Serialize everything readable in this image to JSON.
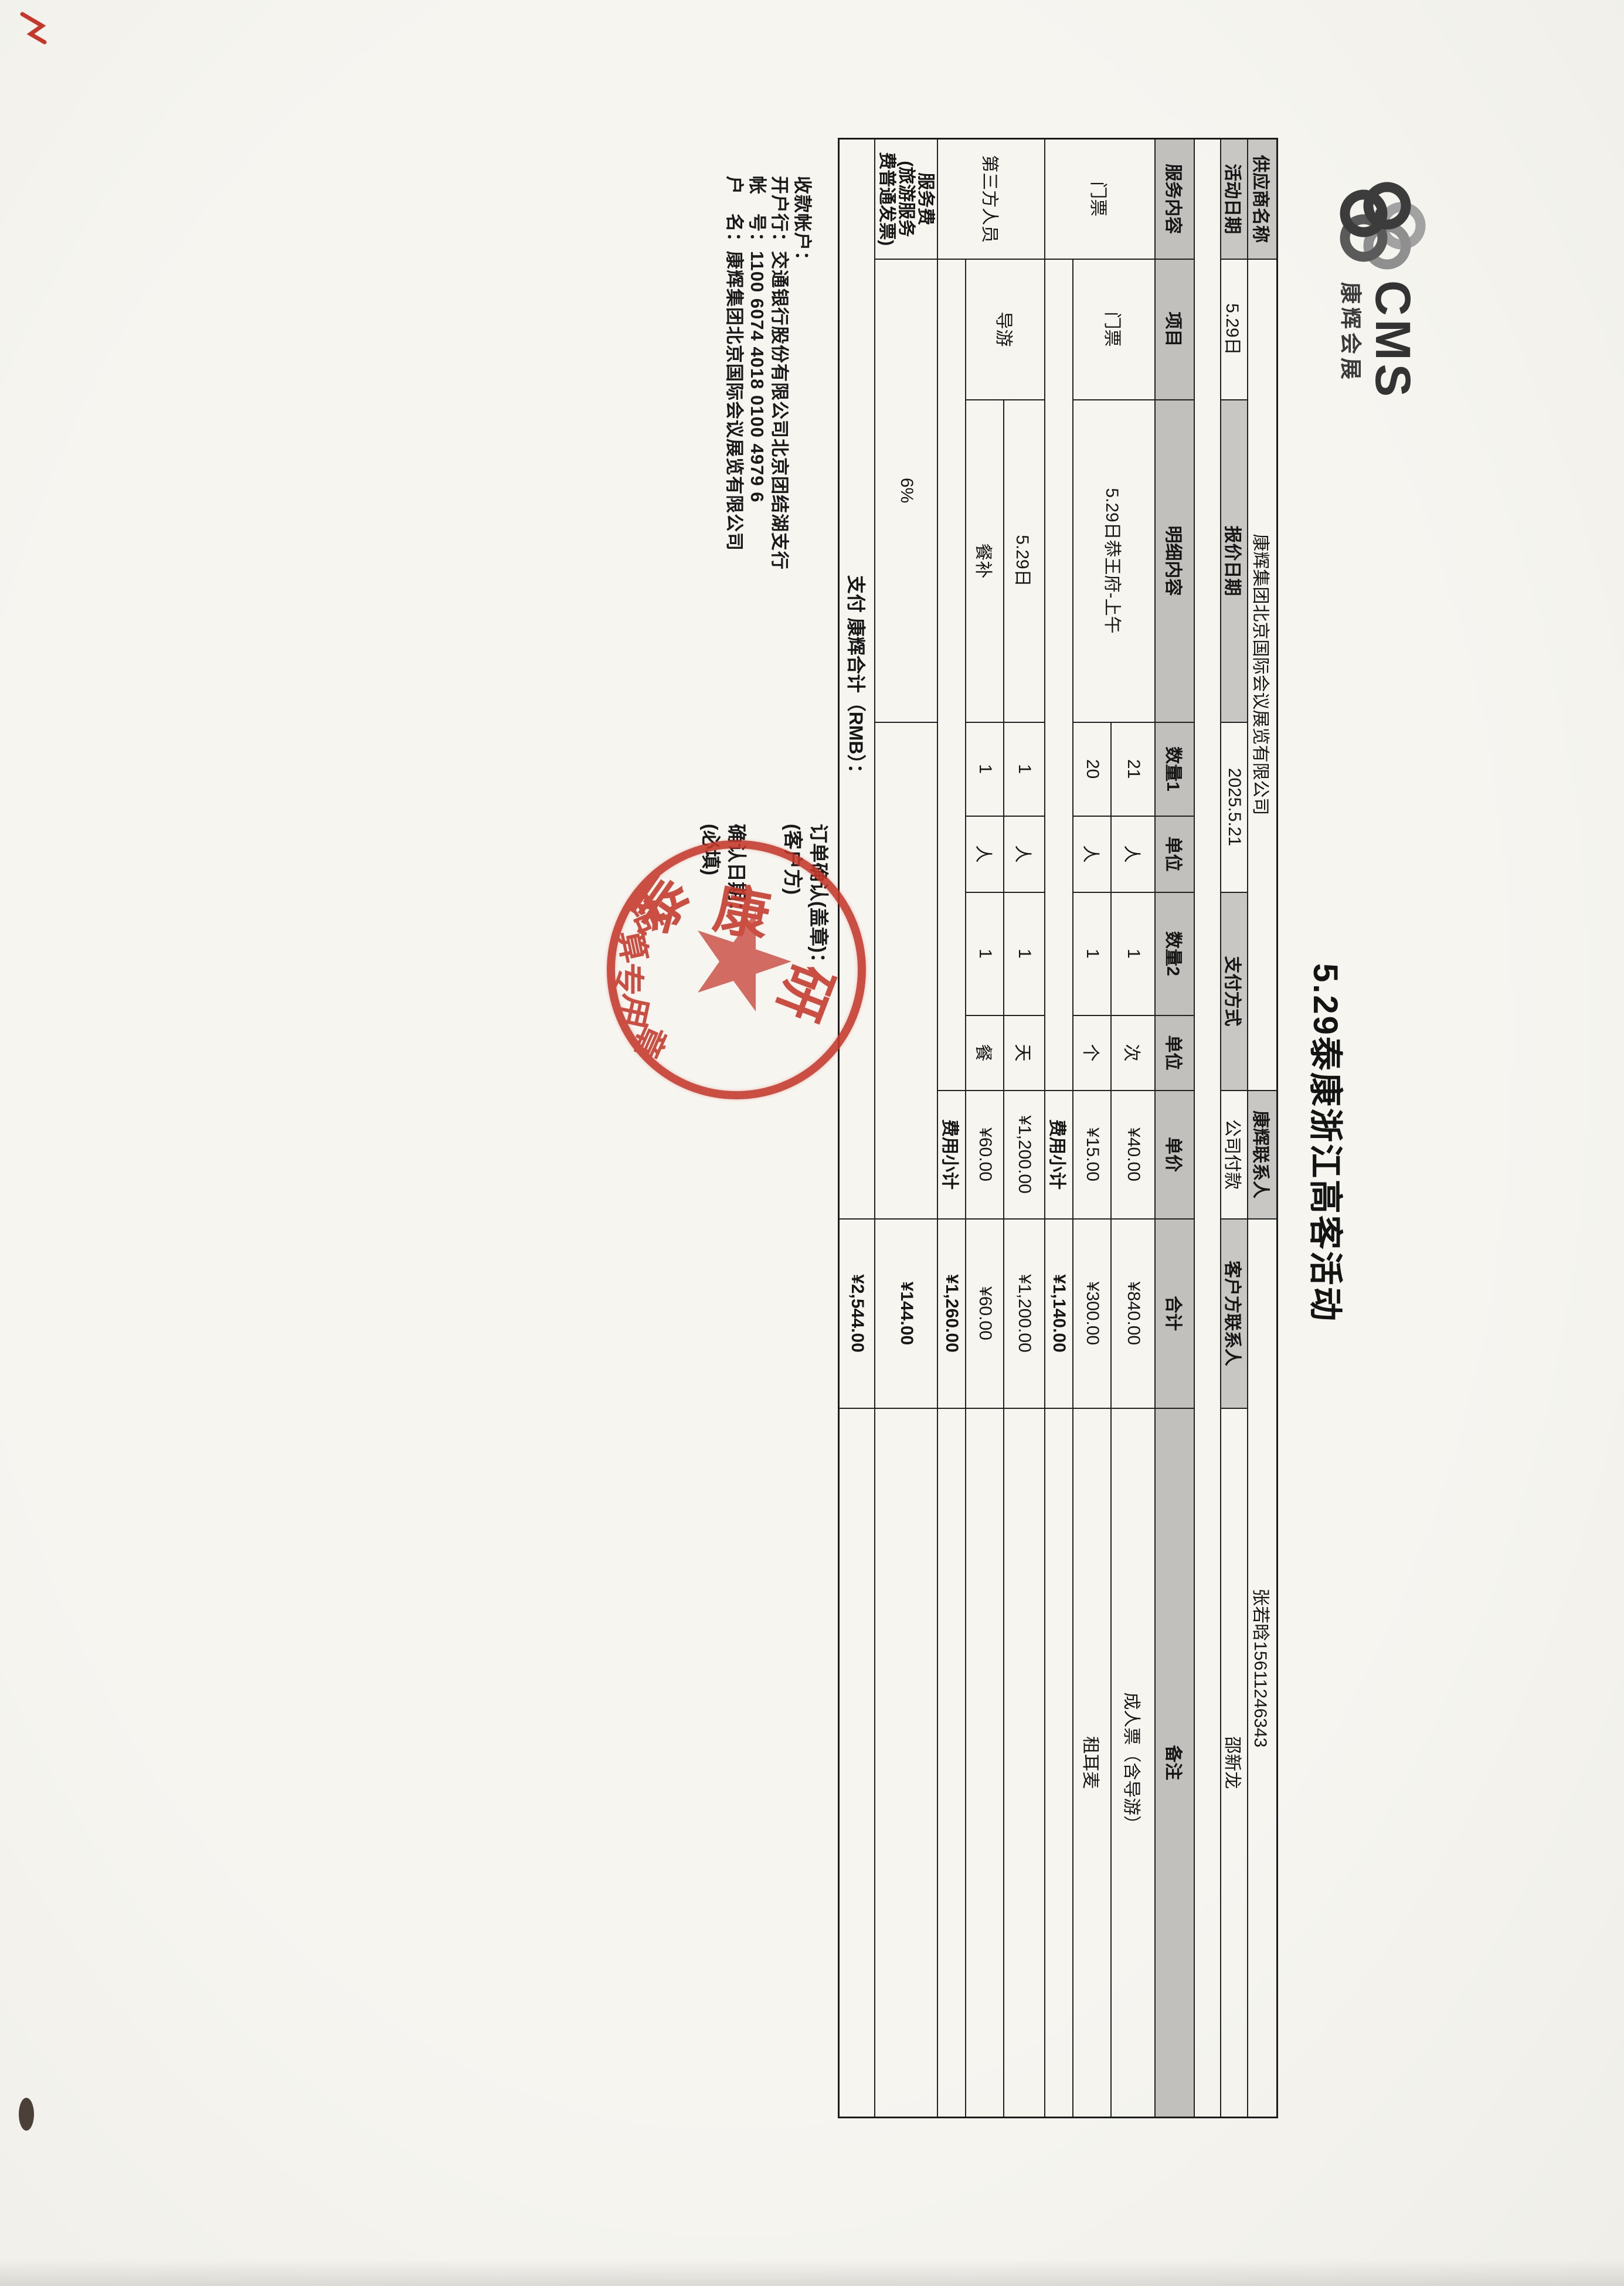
{
  "brand": {
    "cms": "CMS",
    "cn": "康辉会展",
    "flower_icon": "cms-flower-icon"
  },
  "title": "5.29泰康浙江高客活动",
  "info": {
    "supplier_label": "供应商名称",
    "supplier_value": "康辉集团北京国际会议展览有限公司",
    "kh_contact_label": "康辉联系人",
    "kh_contact_value": "张若晗15611246343",
    "event_date_label": "活动日期",
    "event_date_value": "5.29日",
    "quote_date_label": "报价日期",
    "quote_date_value": "2025.5.21",
    "pay_method_label": "支付方式",
    "pay_method_value": "公司付款",
    "client_contact_label": "客户方联系人",
    "client_contact_value": "邵新龙"
  },
  "table": {
    "headers": [
      "服务内容",
      "项目",
      "明细内容",
      "数量1",
      "单位",
      "数量2",
      "单位",
      "单价",
      "合计",
      "备注"
    ],
    "rows": {
      "ticket1": {
        "group": "门票",
        "item": "门票",
        "detail": "5.29日恭王府-上午",
        "qty1": "21",
        "unit1": "人",
        "qty2": "1",
        "unit2": "次",
        "price": "¥40.00",
        "amount": "¥840.00",
        "note": "成人票（含导游）"
      },
      "ticket2": {
        "qty1": "20",
        "unit1": "人",
        "qty2": "1",
        "unit2": "个",
        "price": "¥15.00",
        "amount": "¥300.00",
        "note": "租耳麦"
      },
      "subtotal1": {
        "label": "费用小计",
        "amount": "¥1,140.00"
      },
      "guide": {
        "group": "第三方人员",
        "item": "导游",
        "detail": "5.29日",
        "qty1": "1",
        "unit1": "人",
        "qty2": "1",
        "unit2": "天",
        "price": "¥1,200.00",
        "amount": "¥1,200.00"
      },
      "meal": {
        "detail": "餐补",
        "qty1": "1",
        "unit1": "人",
        "qty2": "1",
        "unit2": "餐",
        "price": "¥60.00",
        "amount": "¥60.00"
      },
      "subtotal2": {
        "label": "费用小计",
        "amount": "¥1,260.00"
      },
      "service": {
        "line1": "服务费",
        "line2": "(旅游服务",
        "line3": "费普通发票)",
        "rate": "6%",
        "amount": "¥144.00"
      },
      "grand": {
        "label": "支付 康辉合计（RMB）：",
        "amount": "¥2,544.00"
      }
    }
  },
  "bank": {
    "line1": "收款帐户：",
    "line2": "开户行：交通银行股份有限公司北京团结湖支行",
    "line3": "帐　号：1100 6074 4018 0100 4979 6",
    "line4": "户　名：康辉集团北京国际会议展览有限公司"
  },
  "confirm": {
    "line1": "订单确认(盖章)：",
    "line2": "(客户方)",
    "line3": "确认日期：",
    "line4": "(必填)"
  },
  "stamp": {
    "arc_chars": [
      "泰",
      "康",
      "研"
    ],
    "bottom_chars": [
      "结",
      "算",
      "专",
      "用",
      "章"
    ],
    "star_icon": "star-icon"
  },
  "colors": {
    "stamp_red": "#c5372b",
    "header_gray": "#c8c7c3",
    "paper": "#f6f5f0",
    "logo_dark": "#3c3c3c",
    "logo_mid": "#6e6e6e",
    "logo_light": "#a2a2a2"
  }
}
